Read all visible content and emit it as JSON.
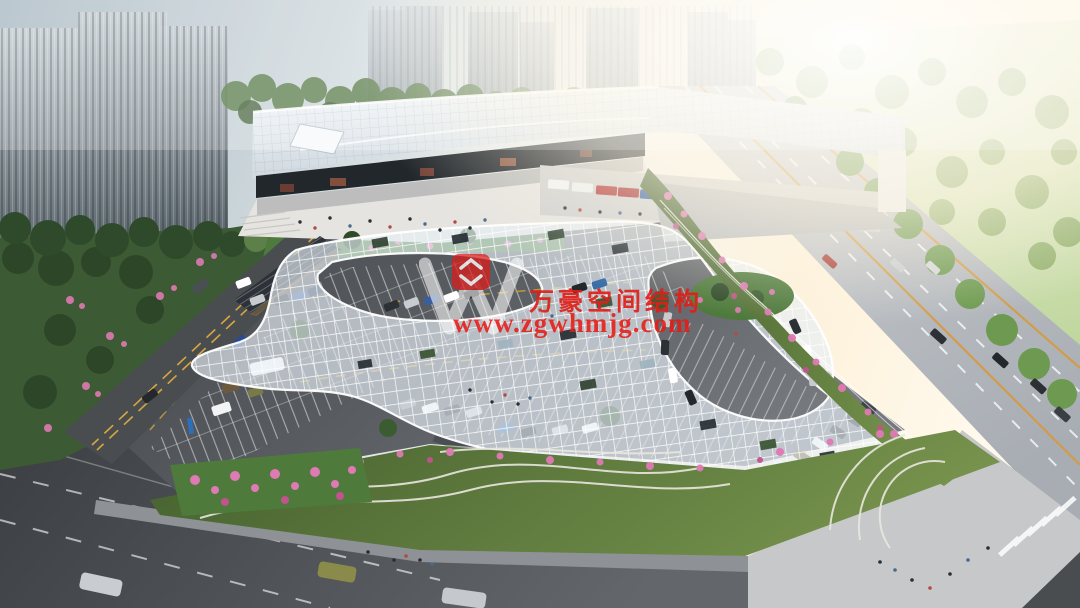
{
  "watermark": {
    "logo_name": "wanhao-w-logo",
    "company_name": "万豪空间结构",
    "website": "www.zgwhmjg.com",
    "text_color": "#e11e18"
  },
  "palette": {
    "sky_left": "#a9b8c2",
    "sun_glare": "#fff7e6",
    "tower_glass": "#5a646b",
    "foliage_dark": "#2f4a2a",
    "foliage_sunlit": "#8fae62",
    "flower_pink": "#e07ab4",
    "canopy_white": "#eef3f7",
    "roof_white": "#f2f5f7",
    "asphalt_dark": "#46494d",
    "road_light": "#bcc0c5",
    "lane_yellow": "#d9a83e"
  }
}
